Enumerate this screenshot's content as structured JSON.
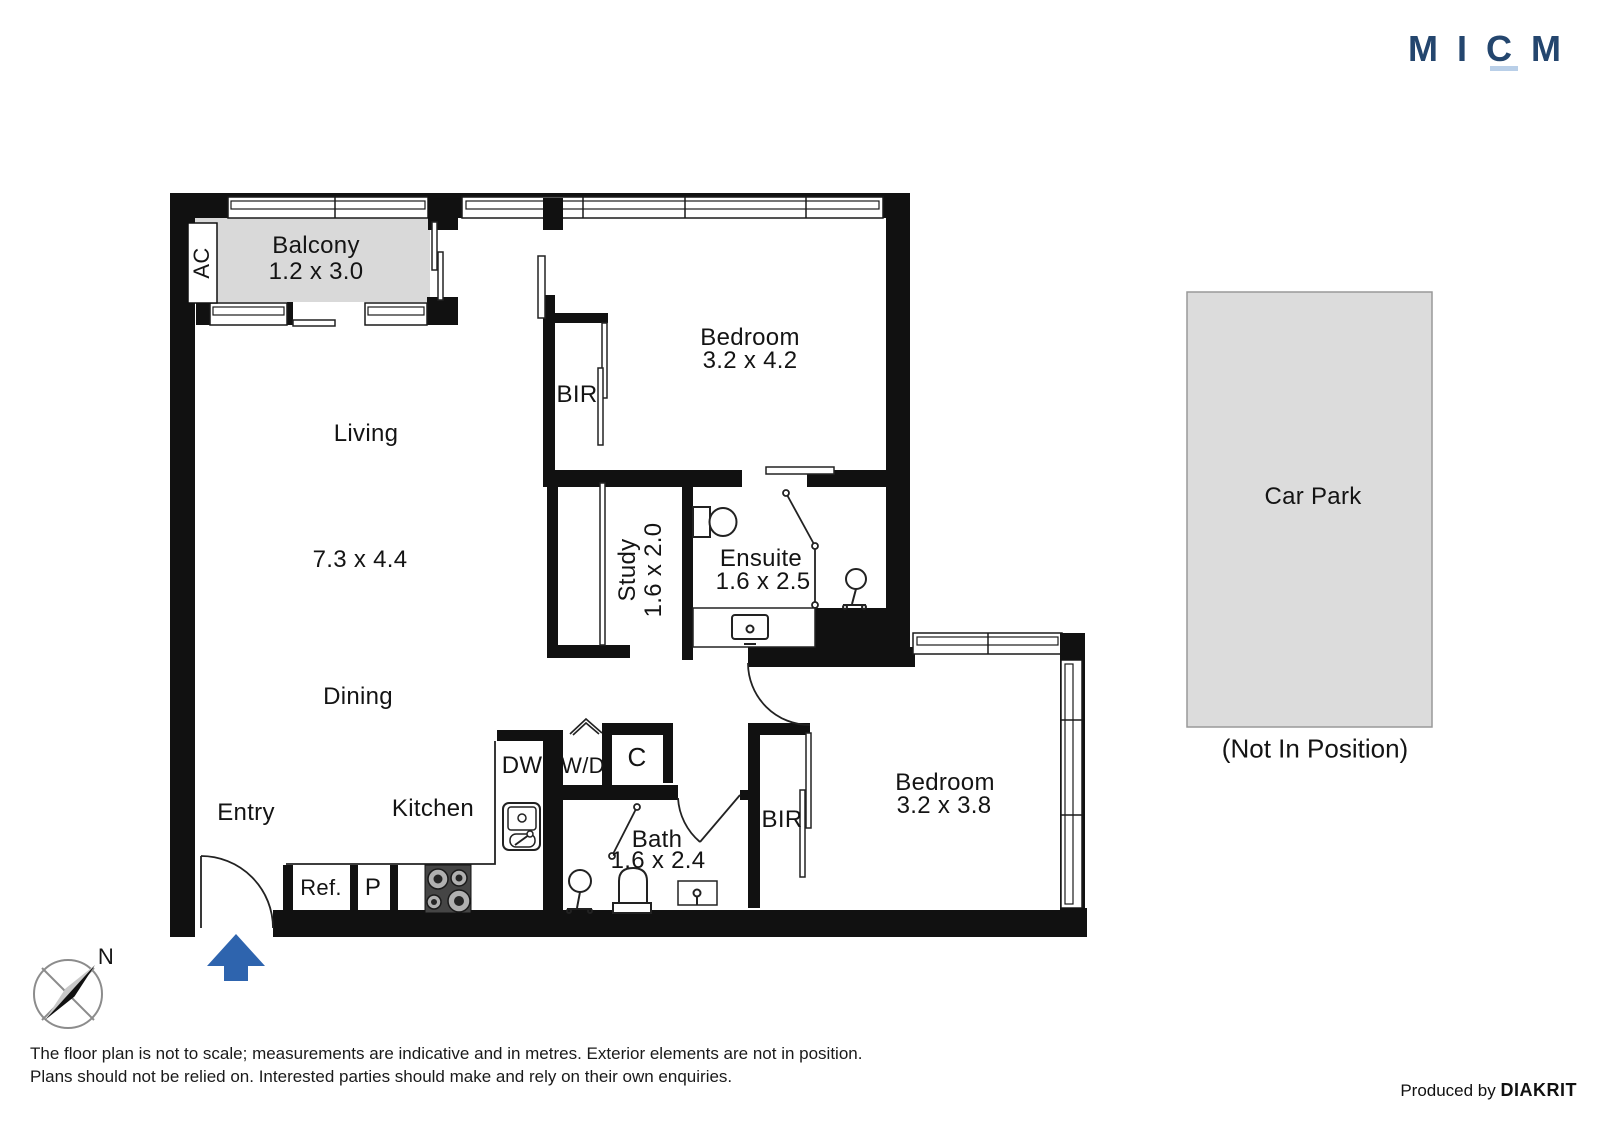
{
  "logo": {
    "text": "MICM"
  },
  "plan": {
    "balcony": {
      "label": "Balcony",
      "dims": "1.2 x 3.0"
    },
    "ac_label": "AC",
    "living": {
      "label": "Living",
      "dims": "7.3 x 4.4"
    },
    "dining_label": "Dining",
    "entry_label": "Entry",
    "kitchen_label": "Kitchen",
    "bedroom1": {
      "label": "Bedroom",
      "dims": "3.2 x 4.2"
    },
    "bedroom2": {
      "label": "Bedroom",
      "dims": "3.2 x 3.8"
    },
    "ensuite": {
      "label": "Ensuite",
      "dims": "1.6 x 2.5"
    },
    "bath": {
      "label": "Bath",
      "dims": "1.6 x 2.4"
    },
    "study": {
      "label": "Study",
      "dims": "1.6 x 2.0"
    },
    "bir1_label": "BIR",
    "bir2_label": "BIR",
    "appliances": {
      "dw": "DW",
      "wd": "W/D",
      "cupboard": "C",
      "fridge": "Ref.",
      "pantry": "P"
    }
  },
  "carpark": {
    "label": "Car Park",
    "note": "(Not In Position)"
  },
  "compass": {
    "north_label": "N"
  },
  "footer": {
    "disclaimer_line1": "The floor plan is not to scale; measurements are indicative and in metres. Exterior elements are not in position.",
    "disclaimer_line2": "Plans should not be relied on. Interested parties should make and rely on their own enquiries.",
    "produced_by_prefix": "Produced by",
    "producer": "DIAKRIT"
  },
  "colors": {
    "wall": "#111111",
    "balcony_fill": "#d9d9d9",
    "carpark_fill": "#dcdcdc",
    "entry_arrow": "#2e64ae",
    "logo_navy": "#24466e",
    "logo_underline": "#b9cfe8"
  }
}
